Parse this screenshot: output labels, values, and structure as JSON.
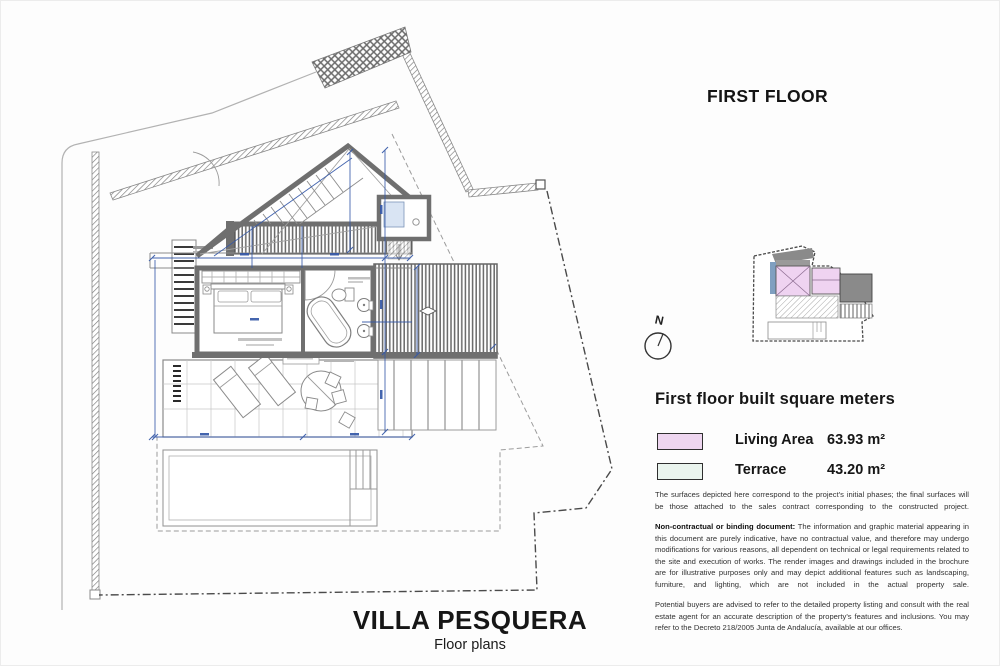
{
  "page_title": "FIRST FLOOR",
  "project": {
    "name": "VILLA PESQUERA",
    "subtitle": "Floor plans"
  },
  "north": {
    "label": "N"
  },
  "legend": {
    "heading": "First floor built square meters",
    "items": [
      {
        "label": "Living Area",
        "value": "63.93 m²",
        "color": "#eed6f0"
      },
      {
        "label": "Terrace",
        "value": "43.20 m²",
        "color": "#eaf4ee"
      }
    ]
  },
  "notes": {
    "surfaces": "The surfaces depicted here correspond to the project's initial phases; the final surfaces will be those attached to the sales contract corresponding to the constructed project.",
    "non_contractual_lead": "Non-contractual or binding document:",
    "non_contractual_body": " The information and graphic material appearing in this document are purely indicative, have no contractual value, and therefore may undergo modifications for various reasons, all dependent on technical or legal requirements related to the site and execution of works. The render images and drawings included in the brochure are for illustrative purposes only and may depict additional features such as landscaping, furniture, and lighting, which are not included in the actual property sale.",
    "buyers": "Potential buyers are advised to refer to the detailed property listing and consult with the real estate agent for an accurate description of the property's features and inclusions. You may refer to the Decreto 218/2005 Junta de Andalucía, available at our offices."
  },
  "colors": {
    "dimension_blue": "#3558a8",
    "wall_gray": "#6f6f6f",
    "living_area_fill": "#eed6f0",
    "terrace_fill": "#eaf4ee"
  }
}
